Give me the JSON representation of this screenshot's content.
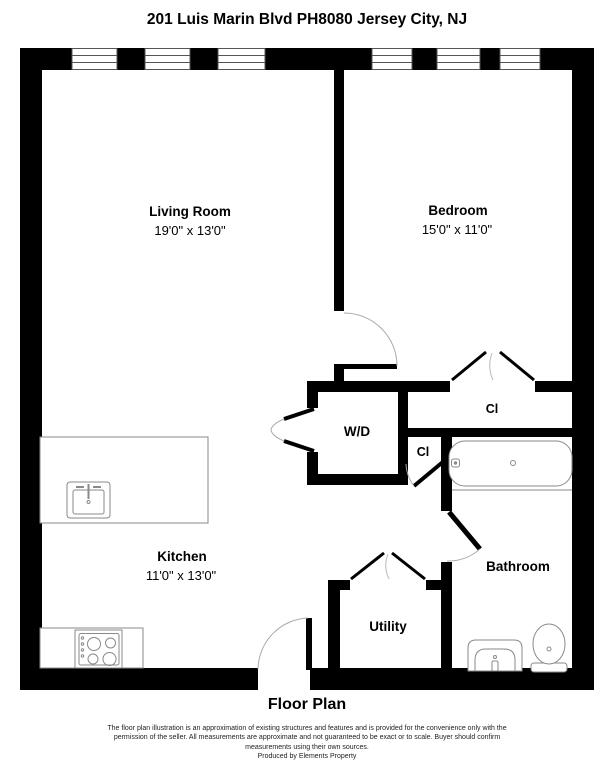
{
  "title": "201 Luis Marin Blvd PH8080 Jersey City, NJ",
  "rooms": {
    "living_room": {
      "name": "Living Room",
      "dims": "19'0\" x 13'0\""
    },
    "bedroom": {
      "name": "Bedroom",
      "dims": "15'0\" x 11'0\""
    },
    "kitchen": {
      "name": "Kitchen",
      "dims": "11'0\" x 13'0\""
    },
    "wd": {
      "name": "W/D"
    },
    "closet_large": {
      "name": "Cl"
    },
    "closet_small": {
      "name": "Cl"
    },
    "bathroom": {
      "name": "Bathroom"
    },
    "utility": {
      "name": "Utility"
    }
  },
  "footer": {
    "caption": "Floor Plan",
    "disclaimer_line1": "The floor plan illustration is an approximation of existing structures and features and is provided for the convenience only with the",
    "disclaimer_line2": "permission of the seller. All measurements are approximate and not guaranteed to be exact or to scale. Buyer should confirm",
    "disclaimer_line3": "measurements using their own sources.",
    "produced_by": "Produced by Elements Property"
  },
  "colors": {
    "wall": "#000000",
    "background": "#ffffff",
    "fixture_line": "#8a8a8a",
    "door_arc": "#aaaaaa"
  }
}
